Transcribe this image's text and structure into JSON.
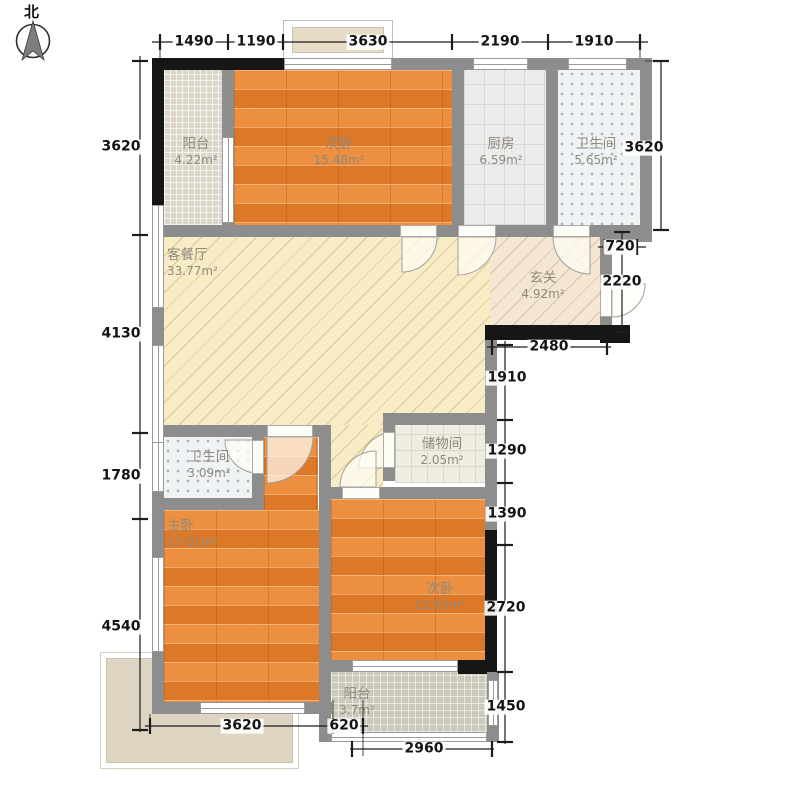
{
  "compass": {
    "label": "北"
  },
  "rooms": [
    {
      "id": "balcony-top",
      "name": "阳台",
      "area": "4.22m²"
    },
    {
      "id": "bedroom-top",
      "name": "次卧",
      "area": "15.48m²"
    },
    {
      "id": "kitchen",
      "name": "厨房",
      "area": "6.59m²"
    },
    {
      "id": "bathroom-top",
      "name": "卫生间",
      "area": "5.65m²"
    },
    {
      "id": "living-dining",
      "name": "客餐厅",
      "area": "33.77m²"
    },
    {
      "id": "foyer",
      "name": "玄关",
      "area": "4.92m²"
    },
    {
      "id": "bathroom-lower",
      "name": "卫生间",
      "area": "3.09m²"
    },
    {
      "id": "storage",
      "name": "储物间",
      "area": "2.05m²"
    },
    {
      "id": "master-bedroom",
      "name": "主卧",
      "area": "17.01m²"
    },
    {
      "id": "bedroom-lower",
      "name": "次卧",
      "area": "12.93m²"
    },
    {
      "id": "balcony-bottom",
      "name": "阳台",
      "area": "3.7m²"
    }
  ],
  "dimensions": {
    "top": [
      "1490",
      "1190",
      "3630",
      "2190",
      "1910"
    ],
    "left": [
      "3620",
      "4130",
      "1780",
      "4540"
    ],
    "right_outer": [
      "3620",
      "720",
      "2220"
    ],
    "right_inner": [
      "2480",
      "1910",
      "1290",
      "1390",
      "2720",
      "1450"
    ],
    "bottom": [
      "3620",
      "620",
      "2960"
    ]
  },
  "colors": {
    "wood_floor": "#e5852f",
    "living_floor": "#f7ecc6",
    "wall_gray": "#8d8d8d",
    "wall_black": "#161616",
    "dim_text": "#141414",
    "room_text": "#8f8a7e"
  }
}
